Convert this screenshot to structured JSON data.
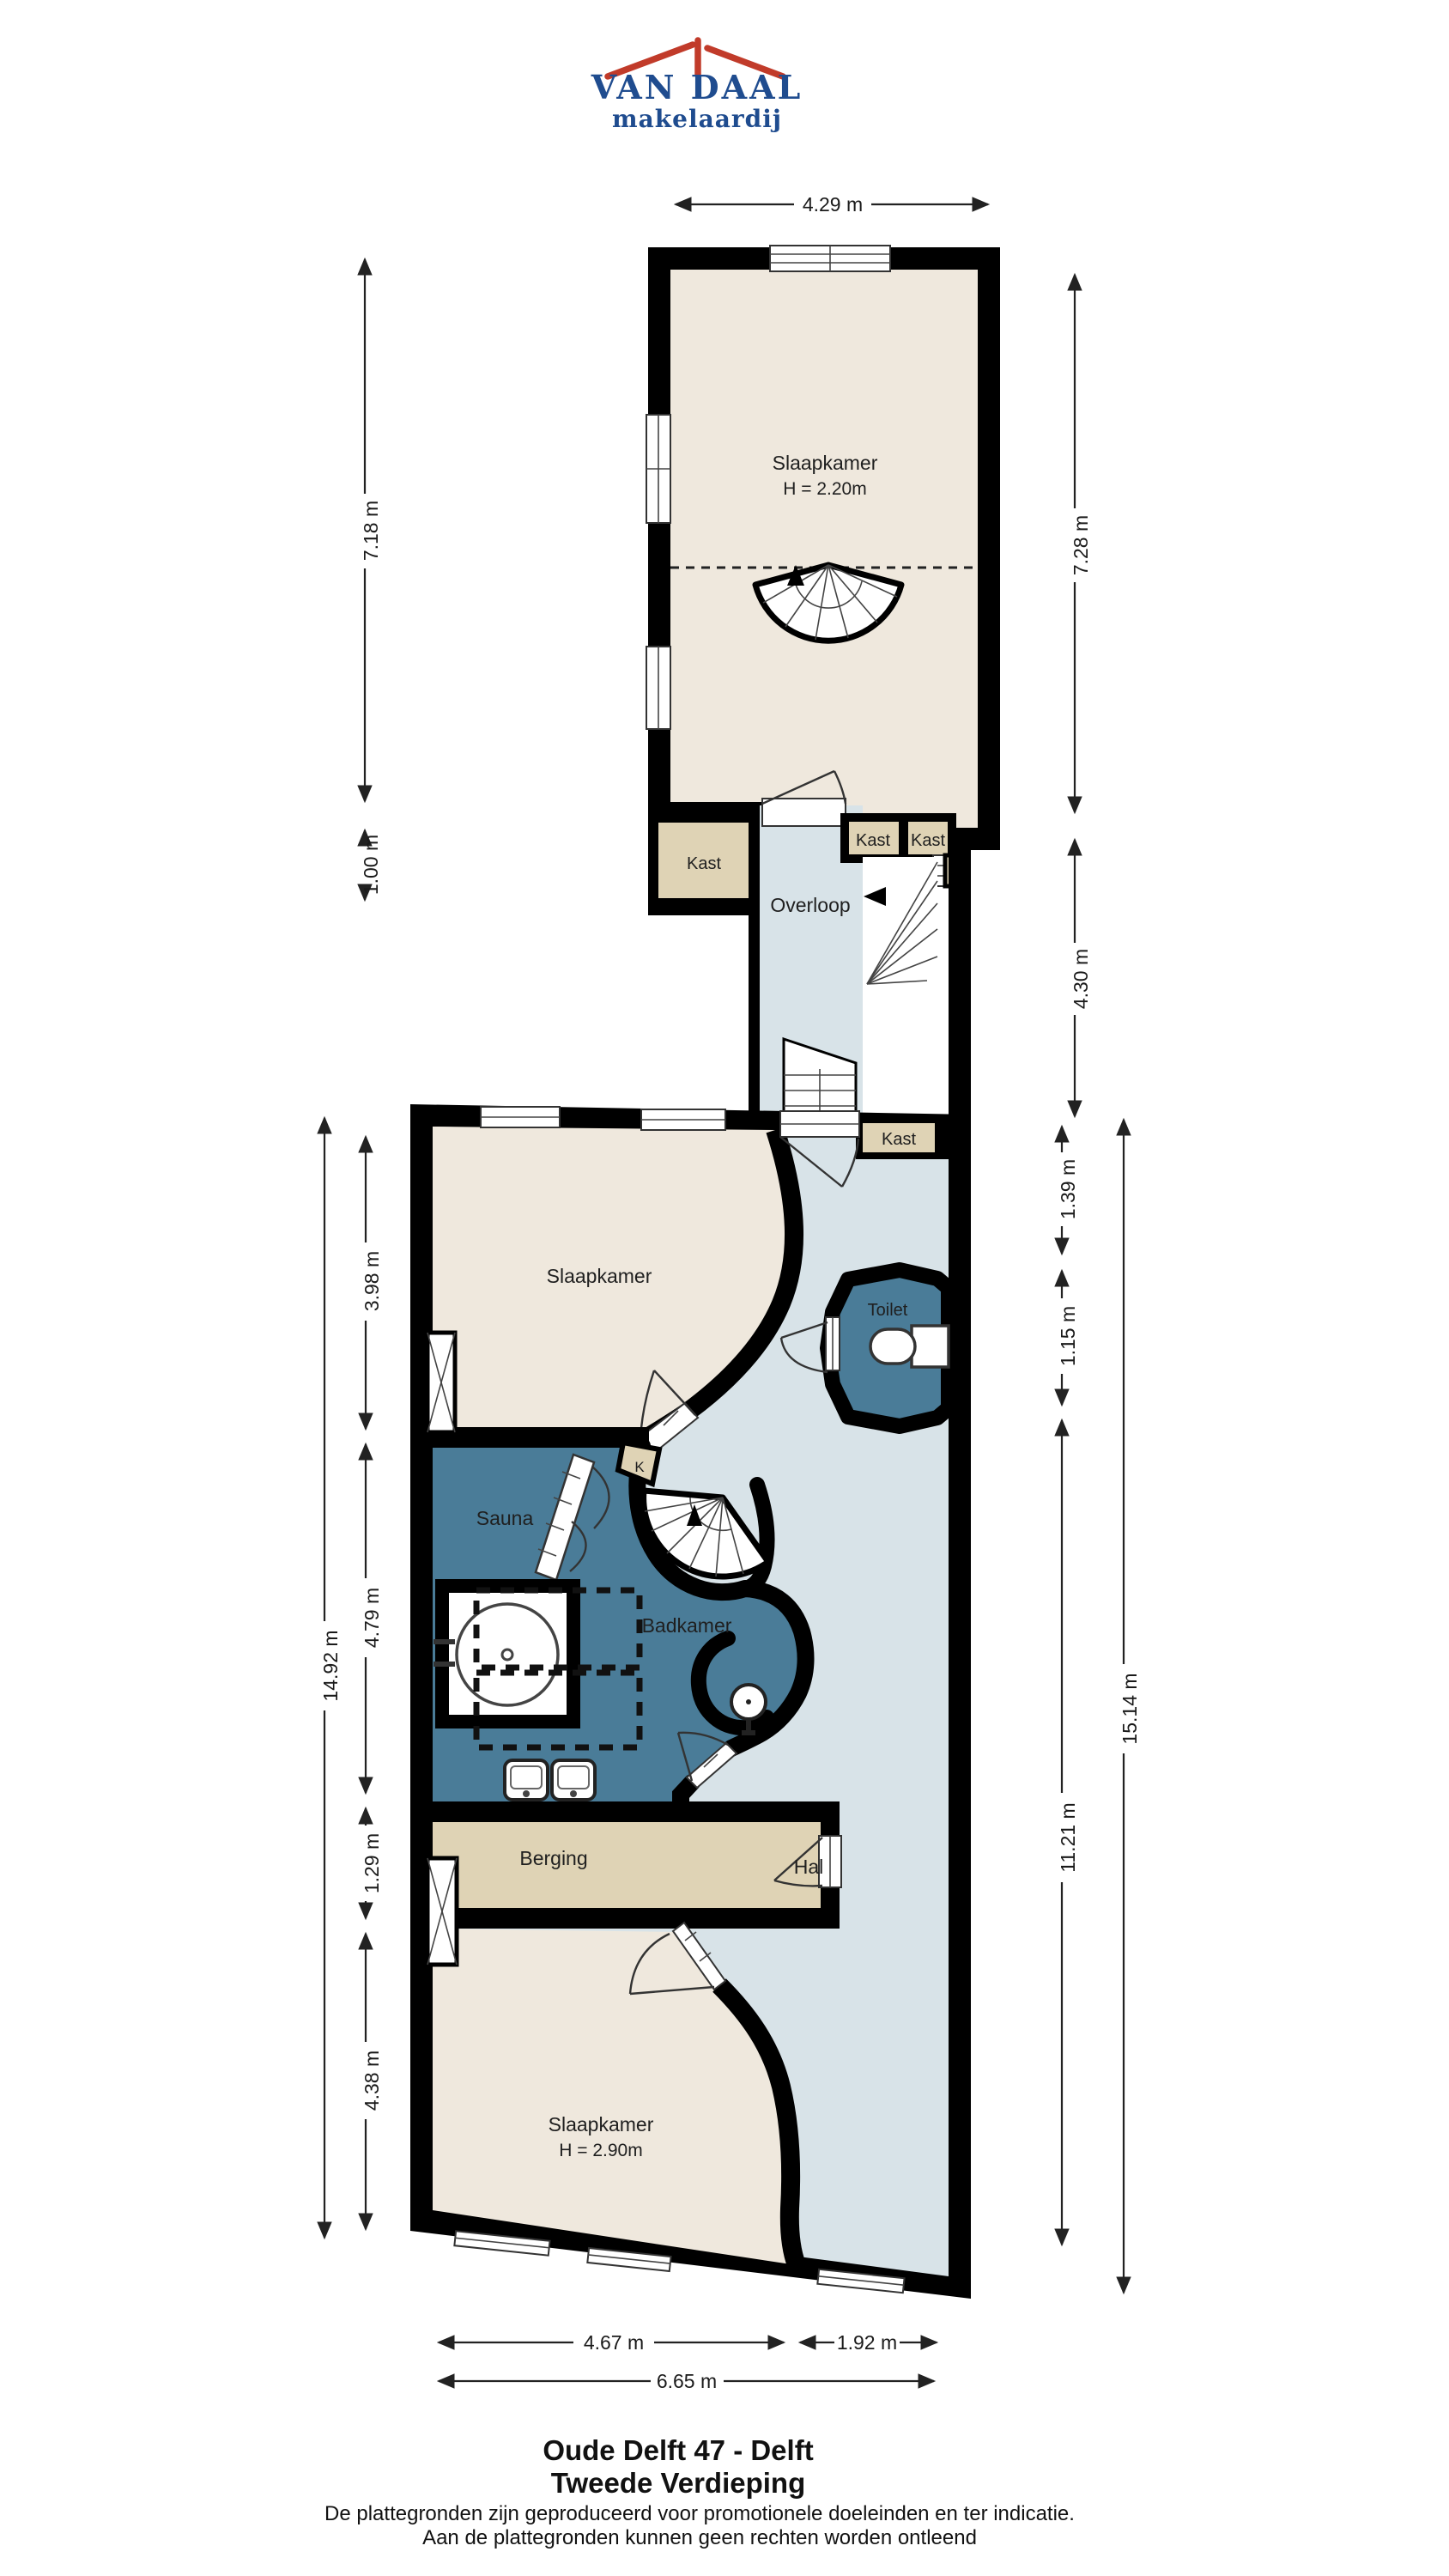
{
  "logo": {
    "name": "VAN DAAL",
    "tagline": "makelaardij"
  },
  "rooms": {
    "slaapkamer_top": "Slaapkamer",
    "slaapkamer_top_h": "H = 2.20m",
    "kast_left": "Kast",
    "kast_a": "Kast",
    "kast_b": "Kast",
    "k_upper": "K",
    "overloop": "Overloop",
    "kast_lower": "Kast",
    "slaapkamer_mid": "Slaapkamer",
    "k_mid": "K",
    "toilet": "Toilet",
    "sauna": "Sauna",
    "badkamer": "Badkamer",
    "berging": "Berging",
    "hal": "Hal",
    "slaapkamer_bottom": "Slaapkamer",
    "slaapkamer_bottom_h": "H = 2.90m"
  },
  "dimensions": {
    "top_width": "4.29 m",
    "upper_left_height": "7.18 m",
    "kast_depth": "1.00 m",
    "upper_right_height": "7.28 m",
    "stairwell_height": "4.30 m",
    "total_left": "14.92 m",
    "mid_bedroom": "3.98 m",
    "bath_zone": "4.79 m",
    "berging_height": "1.29 m",
    "bottom_bedroom": "4.38 m",
    "kast_offset": "1.39 m",
    "toilet_height": "1.15 m",
    "hal_height": "11.21 m",
    "total_right": "15.14 m",
    "bottom_left": "4.67 m",
    "bottom_right": "1.92 m",
    "bottom_total": "6.65 m"
  },
  "title": {
    "line1": "Oude Delft 47 - Delft",
    "line2": "Tweede Verdieping"
  },
  "disclaimer": {
    "line1": "De plattegronden zijn geproduceerd voor promotionele doeleinden en ter indicatie.",
    "line2": "Aan de plattegronden kunnen geen rechten worden ontleend"
  },
  "colors": {
    "wall": "#000000",
    "room_cream": "#EFE8DD",
    "closet_tan": "#DFD3B5",
    "hall_blue": "#D8E3E8",
    "wet_blue": "#4A7C98",
    "logo_red": "#C13B2A",
    "logo_blue": "#1F4C8F"
  }
}
